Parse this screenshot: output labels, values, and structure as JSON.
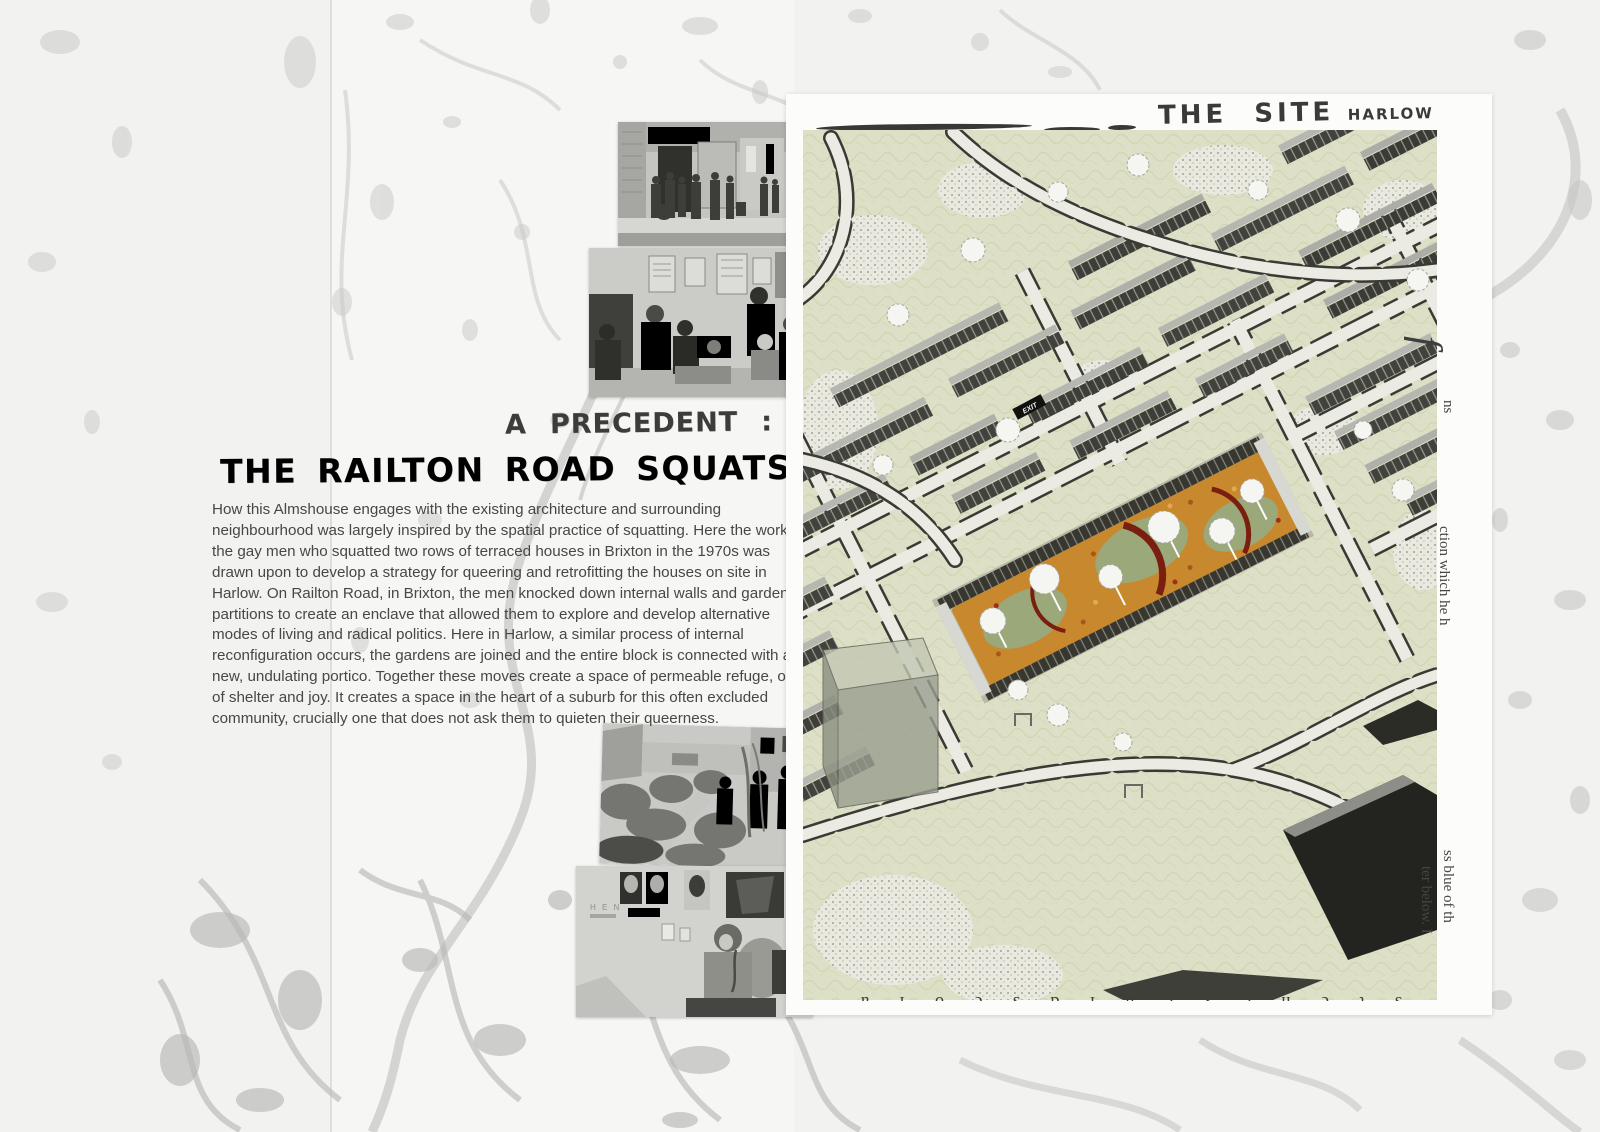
{
  "article": {
    "kicker": "A PRECEDENT :",
    "title": "THE RAILTON ROAD SQUATS",
    "body": "How this Almshouse engages with the existing architecture and surrounding neighbourhood was largely inspired by the spatial practice of squatting. Here the work of the gay men who squatted two rows of terraced houses in Brixton in the 1970s was drawn upon to develop a strategy for queering and retrofitting the houses on site in Harlow. On Railton Road, in Brixton, the men knocked down internal walls and garden partitions to create an enclave that allowed them to explore and develop alternative modes of living and radical politics. Here in Harlow, a similar process of internal reconfiguration occurs, the gardens are joined and the entire block is connected with a new, undulating portico. Together these moves create a space of permeable refuge, one of shelter and joy. It creates a space in the heart of a suburb for this often excluded community, crucially one that does not ask them to quieten their queerness."
  },
  "map": {
    "title": "THE SITE",
    "subtitle": "HARLOW",
    "exit_sign": "EXIT",
    "colors": {
      "paper": "#fcfcfb",
      "sage_ground": "#dde0c6",
      "road_fill": "#ebebe3",
      "road_edge": "#3a3a34",
      "building_dark": "#42423c",
      "roof_light": "#b7b7b1",
      "site_orange": "#c8882e",
      "site_red_wall": "#7a1f10",
      "site_green": "#9aa87a",
      "tree_white": "#f5f5f1",
      "dark_block": "#23231f"
    },
    "fragments": {
      "swash": "f",
      "right_top": "ns",
      "right_mid": "ction which he h",
      "bottom_a": "ss blue of th",
      "bottom_b": "ter below. I",
      "cut_line": "o l a v M i s t e h e x e n i d s e o l a"
    }
  },
  "photos": {
    "photo4_graffiti": "H E N"
  },
  "page": {
    "background": "#f2f2f0",
    "splotch": "#c6c6c4"
  }
}
